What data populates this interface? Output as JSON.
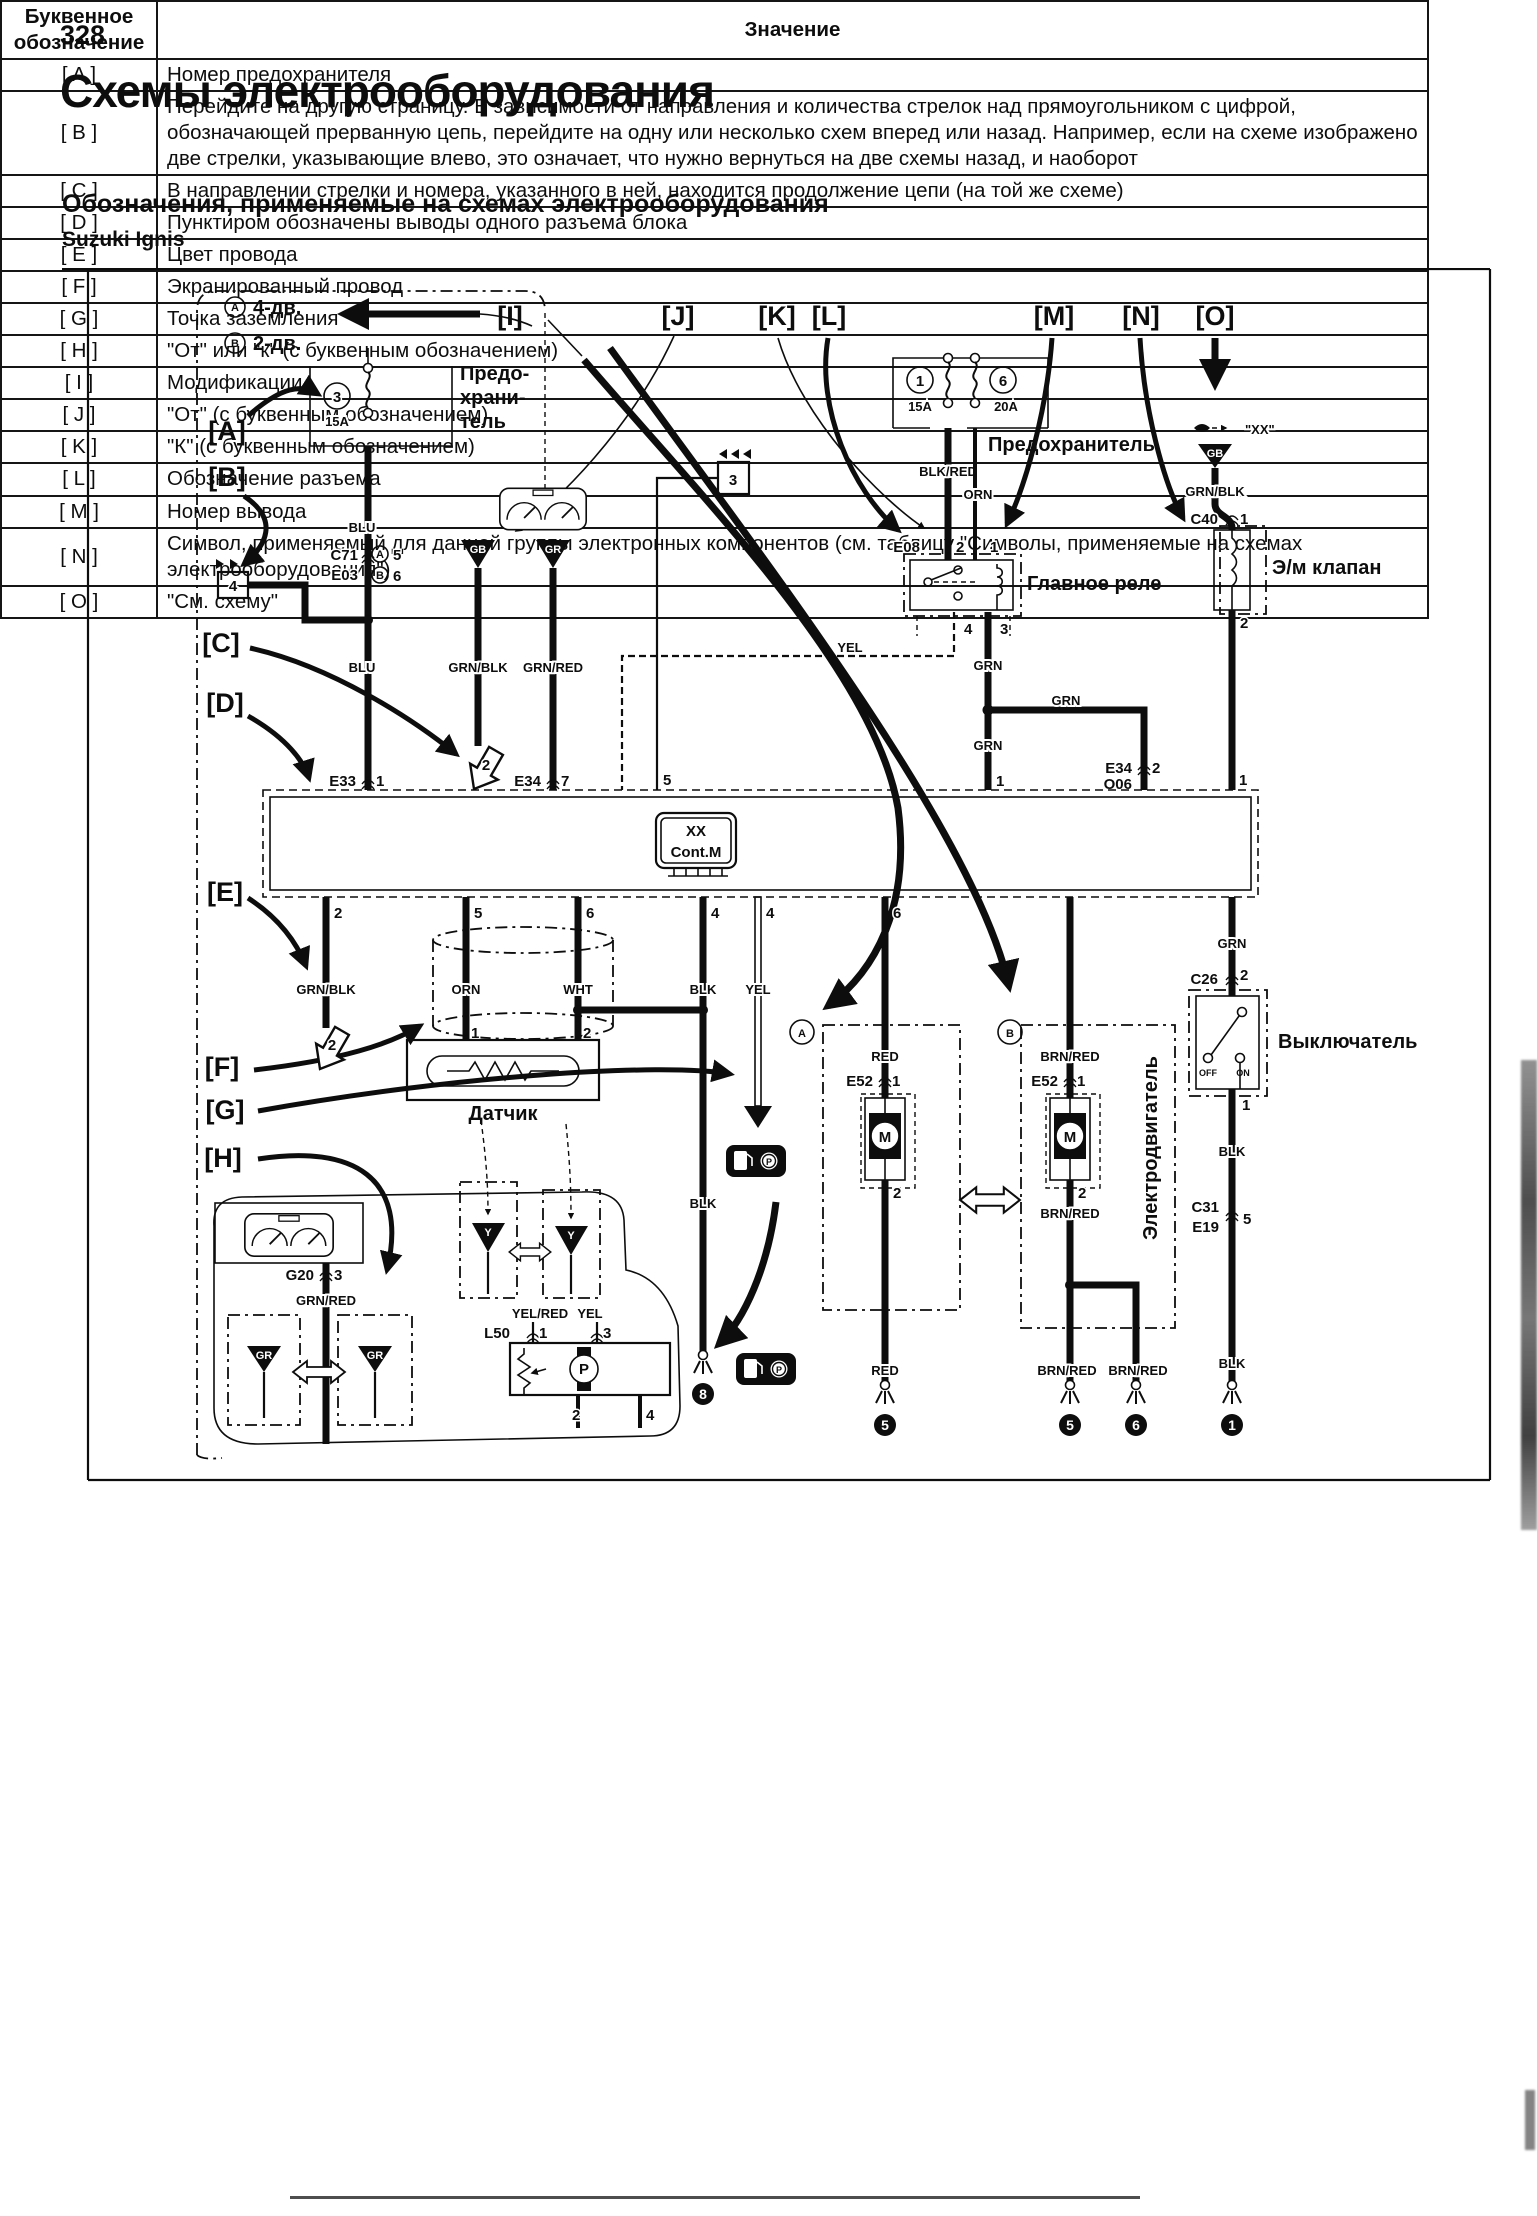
{
  "page": {
    "number": "328",
    "title": "Схемы электрооборудования",
    "subtitle": "Обозначения, применяемые на схемах электрооборудования",
    "model": "Suzuki Ignis"
  },
  "diagram": {
    "marks": {
      "a": "[A]",
      "b": "[B]",
      "c": "[C]",
      "d": "[D]",
      "e": "[E]",
      "f": "[F]",
      "g": "[G]",
      "h": "[H]",
      "i": "[I]",
      "j": "[J]",
      "k": "[K]",
      "l": "[L]",
      "m": "[M]",
      "n": "[N]",
      "o": "[O]"
    },
    "mod_legend": {
      "a_sym": "A",
      "a_text": "4-дв.",
      "b_sym": "B",
      "b_text": "2-дв."
    },
    "fuse_left": {
      "num": "3",
      "amp": "15A",
      "cap1": "Предо-",
      "cap2": "храни-",
      "cap3": "тель"
    },
    "fuse_right": {
      "num1": "1",
      "amp1": "15A",
      "num2": "6",
      "amp2": "20A",
      "caption": "Предохранитель"
    },
    "conn_c71": {
      "c1": "C71",
      "c2": "E03",
      "pa_sym": "A",
      "pa": "5",
      "pb_sym": "B",
      "pb": "6"
    },
    "boxes": {
      "b4": "4",
      "b3": "3"
    },
    "jumps": {
      "top": "2",
      "bottom": "2"
    },
    "tri": {
      "gb": "GB",
      "gr": "GR",
      "y": "Y"
    },
    "wires": {
      "blu": "BLU",
      "grnblk": "GRN/BLK",
      "grnred": "GRN/RED",
      "blkred": "BLK/RED",
      "orn": "ORN",
      "yel": "YEL",
      "grn": "GRN",
      "wht": "WHT",
      "blk": "BLK",
      "red": "RED",
      "brnred": "BRN/RED",
      "yelred": "YEL/RED"
    },
    "relay": {
      "caption": "Главное реле",
      "conn": "E08",
      "pin_l": "2",
      "pin_r": "1",
      "pin_b1": "4",
      "pin_b2": "3"
    },
    "valve": {
      "caption": "Э/м клапан",
      "ref": "\"XX\"",
      "tri": "GB",
      "conn": "C40",
      "pin_t": "1",
      "pin_b": "2",
      "ctrl_pin": "1"
    },
    "ctrl": {
      "chip1": "XX",
      "chip2": "Cont.M",
      "e33": "E33",
      "e33_pin": "1",
      "e34": "E34",
      "e34_pin": "7",
      "pin5": "5",
      "grn_pin": "1",
      "e34r": "E34",
      "e34r_pin": "2",
      "o06": "O06",
      "b1": "2",
      "b2": "5",
      "b3": "6",
      "b4": "4",
      "b5": "4",
      "b6": "6"
    },
    "sensor": {
      "caption": "Датчик",
      "pin1": "1",
      "pin2": "2"
    },
    "switch": {
      "caption": "Выключатель",
      "conn": "C26",
      "pin_t": "2",
      "pin_m": "1",
      "off": "OFF",
      "on": "ON",
      "conn2a": "C31",
      "conn2b": "E19",
      "pin_b": "5"
    },
    "motor": {
      "caption": "Электродвигатель",
      "a_sym": "A",
      "b_sym": "B",
      "conn": "E52",
      "pin_t": "1",
      "pin_b": "2",
      "m": "M"
    },
    "bottom": {
      "g20": "G20",
      "g20_pin": "3",
      "l50": "L50",
      "p1": "1",
      "p3": "3",
      "p2": "2",
      "p4": "4",
      "pump": "P"
    },
    "grounds": {
      "g8": "8",
      "g5a": "5",
      "g5b": "5",
      "g6": "6",
      "g1": "1"
    }
  },
  "table": {
    "header": {
      "col1_line1": "Буквенное",
      "col1_line2": "обозначение",
      "col2": "Значение"
    },
    "rows": [
      {
        "key": "[ A ]",
        "value": "Номер предохранителя"
      },
      {
        "key": "[ B ]",
        "value": "Перейдите на другую страницу. В зависимости от направления и количества стрелок над прямоугольником с цифрой, обозначающей прерванную цепь, перейдите на одну или несколько схем вперед или назад. Например, если на схеме изображено две стрелки, указывающие влево, это означает, что нужно вернуться на две схемы назад, и наоборот"
      },
      {
        "key": "[ C ]",
        "value": "В направлении стрелки и номера, указанного в ней, находится продолжение цепи (на той же схеме)"
      },
      {
        "key": "[ D ]",
        "value": "Пунктиром обозначены выводы одного разъема блока"
      },
      {
        "key": "[ E ]",
        "value": "Цвет провода"
      },
      {
        "key": "[ F ]",
        "value": "Экранированный провод"
      },
      {
        "key": "[ G ]",
        "value": "Точка заземления"
      },
      {
        "key": "[ H ]",
        "value": "\"От\" или \"к\" (с буквенным обозначением)"
      },
      {
        "key": "[ I ]",
        "value": "Модификации"
      },
      {
        "key": "[ J ]",
        "value": "\"От\" (с буквенным обозначением)"
      },
      {
        "key": "[ K ]",
        "value": "\"К\" (с буквенным обозначением)"
      },
      {
        "key": "[ L ]",
        "value": "Обозначение разъема"
      },
      {
        "key": "[ M ]",
        "value": "Номер вывода"
      },
      {
        "key": "[ N ]",
        "value": "Символ, применяемый для данной группы электронных компонентов (см. таблицу \"Символы, применяемые на схемах электрооборудования\")"
      },
      {
        "key": "[ O ]",
        "value": "\"См. схему\""
      }
    ]
  }
}
